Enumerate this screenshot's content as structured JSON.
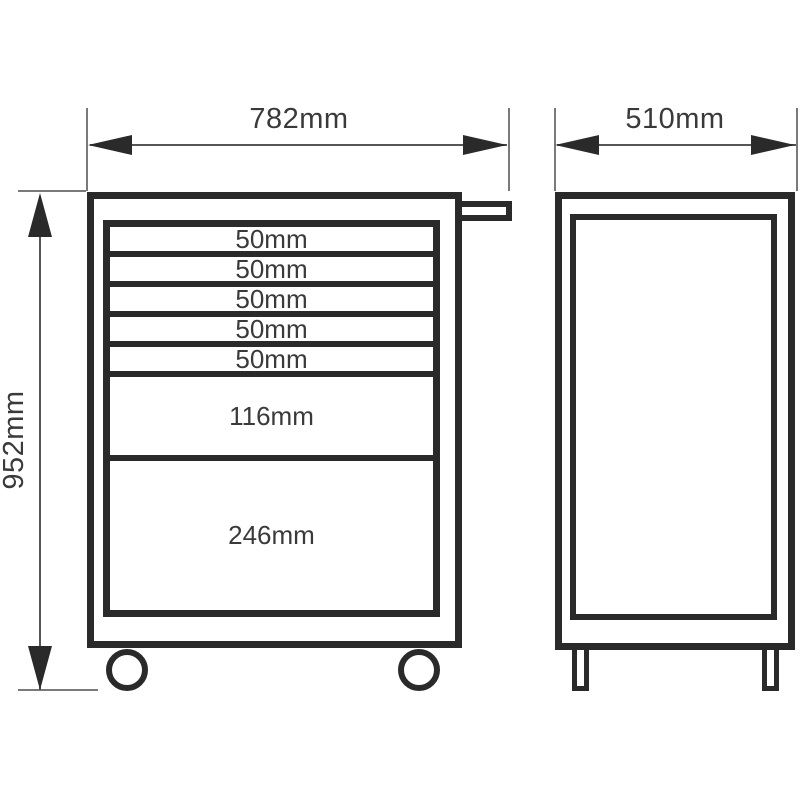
{
  "dimensions": {
    "front_width": {
      "label": "782mm"
    },
    "side_depth": {
      "label": "510mm"
    },
    "overall_height": {
      "label": "952mm"
    }
  },
  "front_view": {
    "drawers": [
      {
        "label": "50mm"
      },
      {
        "label": "50mm"
      },
      {
        "label": "50mm"
      },
      {
        "label": "50mm"
      },
      {
        "label": "50mm"
      },
      {
        "label": "116mm"
      },
      {
        "label": "246mm"
      }
    ]
  },
  "colors": {
    "line": "#2a2a2a",
    "thin_line": "#7a7a7a",
    "dim_line": "#555555",
    "text": "#3a3a3a",
    "background": "#ffffff"
  }
}
